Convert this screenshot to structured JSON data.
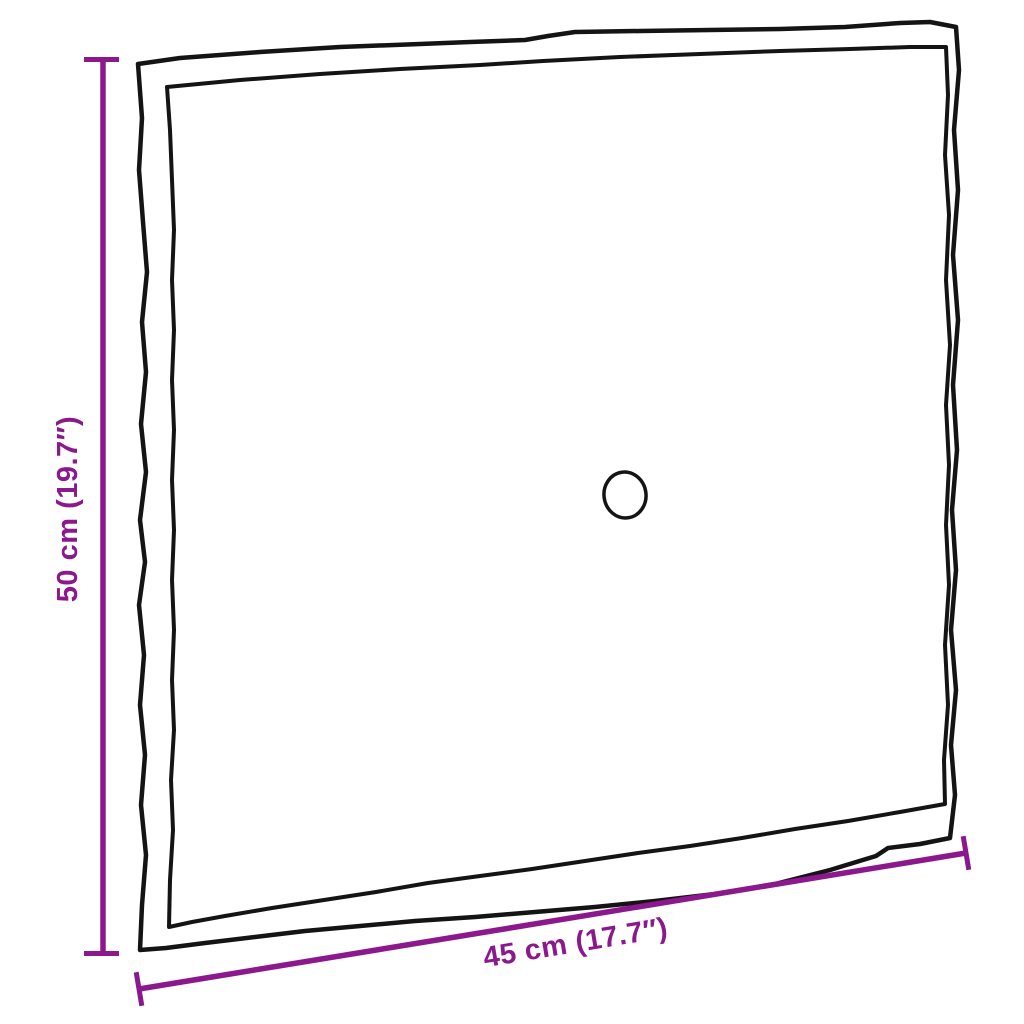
{
  "diagram": {
    "background_color": "#ffffff",
    "outline_color": "#141414",
    "dimension_color": "#8B188C",
    "height_dimension": {
      "label": "50 cm (19.7″)"
    },
    "width_dimension": {
      "label": "45 cm (17.7″)"
    }
  }
}
